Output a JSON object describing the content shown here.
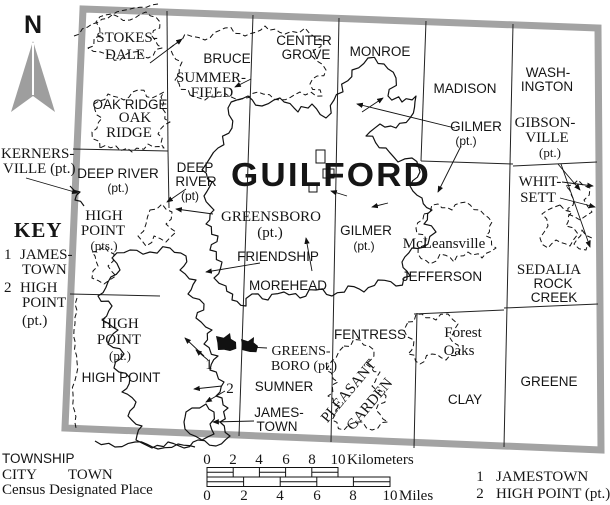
{
  "colors": {
    "county_border_gray": "#a3a3a3",
    "guilford_text_gray": "#9c9c9c",
    "ink": "#151515"
  },
  "map_labels": {
    "north": "N",
    "guilford": "GUILFORD",
    "stokesdale1": "STOKES-",
    "stokesdale2": "DALE",
    "bruce": "BRUCE",
    "center1": "CENTER",
    "center2": "GROVE",
    "monroe": "MONROE",
    "madison": "MADISON",
    "wash1": "WASH-",
    "wash2": "INGTON",
    "summer1": "SUMMER-",
    "summer2": "FIELD",
    "oakridge_twp": "OAK RIDGE",
    "oakridge1": "OAK",
    "oakridge2": "RIDGE",
    "gilmer_ne1": "GILMER",
    "gilmer_ne2": "(pt.)",
    "gibson1": "GIBSON-",
    "gibson2": "VILLE",
    "gibson3": "(pt.)",
    "kerners1": "KERNERS-",
    "kerners2": "VILLE (pt.)",
    "deepriver_w1": "DEEP RIVER",
    "deepriver_w2": "(pt.)",
    "deepriver_c1": "DEEP",
    "deepriver_c2": "RIVER",
    "deepriver_c3": "(pt)",
    "greensboro1": "GREENSBORO",
    "greensboro2": "(pt.)",
    "gilmer_c1": "GILMER",
    "gilmer_c2": "(pt.)",
    "mcleansville": "McLeansville",
    "whitsett1": "WHIT-",
    "whitsett2": "SETT",
    "highpoint_pts1": "HIGH",
    "highpoint_pts2": "POINT",
    "highpoint_pts3": "(pts.)",
    "friendship": "FRIENDSHIP",
    "morehead": "MOREHEAD",
    "jefferson": "JEFFERSON",
    "sedalia": "SEDALIA",
    "rockcreek1": "ROCK",
    "rockcreek2": "CREEK",
    "highpoint_pt1": "HIGH",
    "highpoint_pt2": "POINT",
    "highpoint_pt3": "(pt.)",
    "highpoint_twp": "HIGH POINT",
    "fentress": "FENTRESS",
    "forest1": "Forest",
    "forest2": "Oaks",
    "greensboro_s1": "GREENS-",
    "greensboro_s2": "BORO (pt.)",
    "sumner": "SUMNER",
    "pleasant1": "PLEASANT",
    "pleasant2": "GARDEN",
    "clay": "CLAY",
    "greene": "GREENE",
    "jamestown1": "JAMES-",
    "jamestown2": "TOWN",
    "marker1": "1",
    "marker2": "2"
  },
  "key_panel": {
    "title": "KEY",
    "i1num": "1",
    "i1a": "JAMES-",
    "i1b": "TOWN",
    "i2num": "2",
    "i2a": "HIGH",
    "i2b": "POINT",
    "i2c": "(pt.)"
  },
  "legend": {
    "township": "TOWNSHIP",
    "city": "CITY",
    "town": "TOWN",
    "cdp": "Census Designated Place",
    "km": [
      "0",
      "2",
      "4",
      "6",
      "8",
      "10"
    ],
    "km_unit": "Kilometers",
    "mi": [
      "0",
      "2",
      "4",
      "6",
      "8",
      "10"
    ],
    "mi_unit": "Miles",
    "k1n": "1",
    "k1": "JAMESTOWN",
    "k2n": "2",
    "k2": "HIGH POINT (pt.)"
  }
}
